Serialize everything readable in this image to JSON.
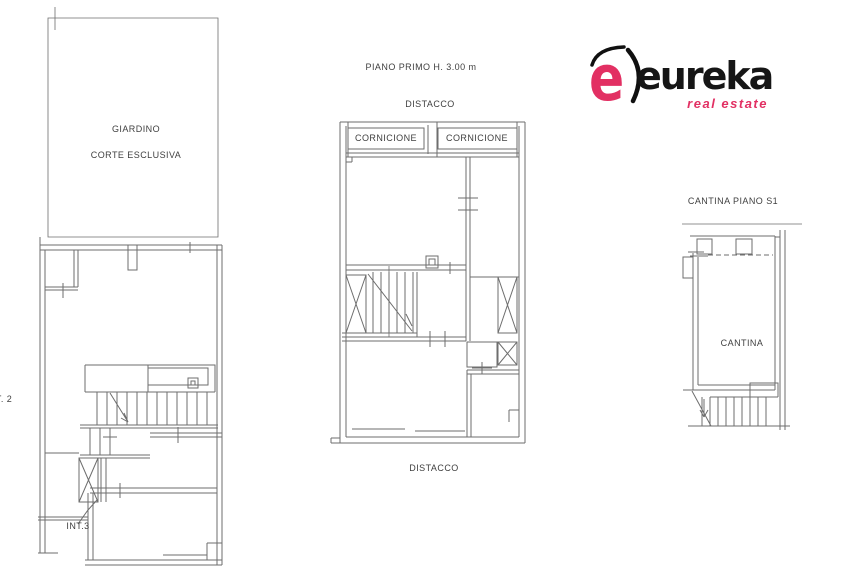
{
  "logo": {
    "e_mark": "e",
    "brand": "eureka",
    "tagline": "real estate",
    "accent_color": "#e23063",
    "text_color": "#161616"
  },
  "plans": {
    "left": {
      "garden_line1": "GIARDINO",
      "garden_line2": "CORTE ESCLUSIVA",
      "unit_label_top": "INT. 2",
      "unit_label_bottom": "INT.3"
    },
    "middle": {
      "title": "PIANO PRIMO H. 3.00 m",
      "detachment_top": "DISTACCO",
      "cornice_left": "CORNICIONE",
      "cornice_right": "CORNICIONE",
      "detachment_bottom": "DISTACCO"
    },
    "right": {
      "title": "CANTINA PIANO S1",
      "room_label": "CANTINA"
    }
  },
  "drawing": {
    "line_color": "#6e6e6e"
  }
}
